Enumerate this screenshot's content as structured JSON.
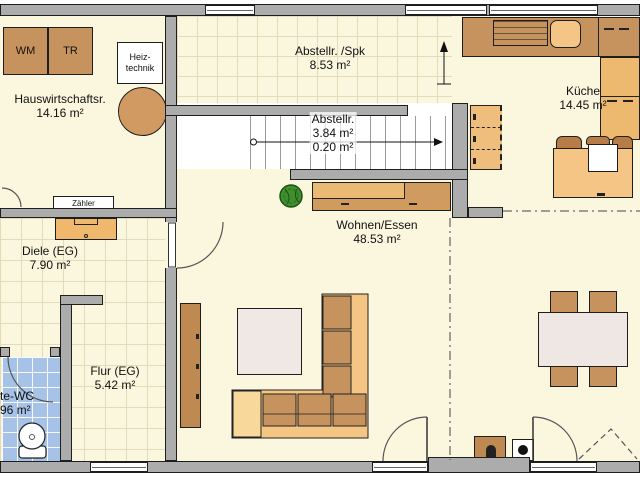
{
  "rooms": {
    "hauswirtschaftsraum": {
      "name": "Hauswirtschaftsr.",
      "area": "14.16 m²"
    },
    "abstellraum_spk": {
      "name": "Abstellr. /Spk",
      "area": "8.53 m²"
    },
    "kueche": {
      "name": "Küche",
      "area": "14.45 m²"
    },
    "abstellraum_treppe": {
      "name": "Abstellr.",
      "area": "3.84 m²",
      "area2": "0.20 m²"
    },
    "diele": {
      "name": "Diele (EG)",
      "area": "7.90 m²"
    },
    "wohnen_essen": {
      "name": "Wohnen/Essen",
      "area": "48.53 m²"
    },
    "flur": {
      "name": "Flur (EG)",
      "area": "5.42 m²"
    },
    "gaeste_wc": {
      "name": "te-WC",
      "area": "96 m²"
    }
  },
  "labels": {
    "washing_machine": "WM",
    "dryer": "TR",
    "heiztechnik": [
      "Heiz-",
      "technik"
    ],
    "zaehler": "Zähler"
  },
  "colors": {
    "wall": "#ACACAC",
    "floor": "#FBF7DF",
    "wc_tile": "#A6C2E7",
    "wood": "#C6935F",
    "wood_light": "#F4C584",
    "table": "#EFE7E3",
    "plant": "#3F8F2F"
  }
}
